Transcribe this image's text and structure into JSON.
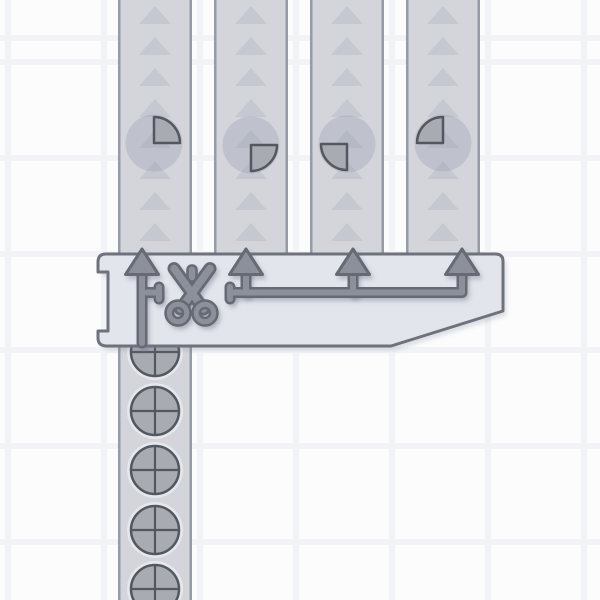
{
  "scene": {
    "description": "factory game scene with a quad cutter building, four output belts carrying quarter shapes, and one input belt carrying full quartered circle shapes",
    "grid": {
      "cell_size": 96,
      "line_width": 6,
      "offset_x": 5,
      "offset_y": 59
    },
    "palette": {
      "background": "#fcfcfd",
      "grid_line": "#f2f3f6",
      "belt_fill": "#d3d5db",
      "belt_edge": "#969ba6",
      "belt_arrow": "#c5c8d0",
      "item_ghost": "rgba(141,148,164,0.28)",
      "shape_fill": "#a8abb2",
      "shape_stroke": "#53575f",
      "item_halo": "rgba(234,236,240,0.75)",
      "building_fill": "#e3e5ec",
      "building_stroke": "#6e727b",
      "icon_fill": "#8c909a",
      "icon_stroke": "#666a73",
      "diagram_shadow": "rgba(112,118,136,0.30)",
      "building_shadow": "rgba(112,118,136,0.22)"
    },
    "output_belts": [
      {
        "id": "output-belt-1",
        "x": 118,
        "width": 74,
        "y_top": 0,
        "y_bottom": 255,
        "direction": "up",
        "item": {
          "type": "quarter",
          "quadrant": "top-right",
          "cx": 154,
          "cy": 143,
          "radius": 26,
          "ghost_radius": 28.5
        }
      },
      {
        "id": "output-belt-2",
        "x": 214,
        "width": 74,
        "y_top": 0,
        "y_bottom": 255,
        "direction": "up",
        "item": {
          "type": "quarter",
          "quadrant": "bottom-right",
          "cx": 251,
          "cy": 145,
          "radius": 26,
          "ghost_radius": 28.5
        }
      },
      {
        "id": "output-belt-3",
        "x": 310,
        "width": 74,
        "y_top": 0,
        "y_bottom": 255,
        "direction": "up",
        "item": {
          "type": "quarter",
          "quadrant": "bottom-left",
          "cx": 347,
          "cy": 144,
          "radius": 26,
          "ghost_radius": 28.5
        }
      },
      {
        "id": "output-belt-4",
        "x": 406,
        "width": 74,
        "y_top": 0,
        "y_bottom": 255,
        "direction": "up",
        "item": {
          "type": "quarter",
          "quadrant": "top-left",
          "cx": 443,
          "cy": 143,
          "radius": 26,
          "ghost_radius": 28.5
        }
      }
    ],
    "belt_arrow_geometry": {
      "first_center_y": 16,
      "spacing": 31,
      "half_width": 16,
      "tip_up": 10,
      "base_down": 8
    },
    "input_belt": {
      "id": "input-belt",
      "x": 118,
      "width": 74,
      "y_top": 338,
      "y_bottom": 600,
      "direction": "up",
      "item_type": "circle-four-quarters",
      "items_cy": [
        352,
        411,
        470,
        530,
        589
      ],
      "item_radius": 24,
      "halo_radius": 28,
      "item_cx": 155
    },
    "building": {
      "id": "quad-cutter",
      "icon": "scissors-icon",
      "left": 98,
      "top": 254,
      "right": 503,
      "bottom": 346,
      "chamfer_start_y": 311,
      "chamfer_end_x": 391,
      "notch": {
        "y1": 272,
        "y2": 331,
        "inset_x": 108
      },
      "diagram": {
        "output_arrows_x": [
          142,
          246,
          353,
          462
        ],
        "shaft_top_y": 266,
        "line_y": 292.5,
        "line_x1": 230,
        "line_x2": 462,
        "input_shaft_bottom_y": 343,
        "tap": {
          "x1": 147,
          "x2": 156,
          "cap_x": 159
        },
        "cap2_x": 230,
        "cap_y1": 287,
        "cap_y2": 299,
        "head_half_width": 16.5,
        "head_tip_y": 249,
        "head_base_y": 274.5
      },
      "scissors": {
        "screw": {
          "x": 187.5,
          "y": 265.5,
          "w": 9,
          "h": 16,
          "r": 4
        },
        "blades": [
          [
            174,
            268.5,
            203.5,
            309
          ],
          [
            210,
            268.5,
            180.5,
            309
          ]
        ],
        "rings": [
          [
            178,
            313
          ],
          [
            205,
            313
          ]
        ],
        "ring_radius": 8.75
      },
      "shadow_offset": [
        3.5,
        4.5
      ],
      "diagram_shadow_offset": [
        2.5,
        3.5
      ]
    }
  }
}
